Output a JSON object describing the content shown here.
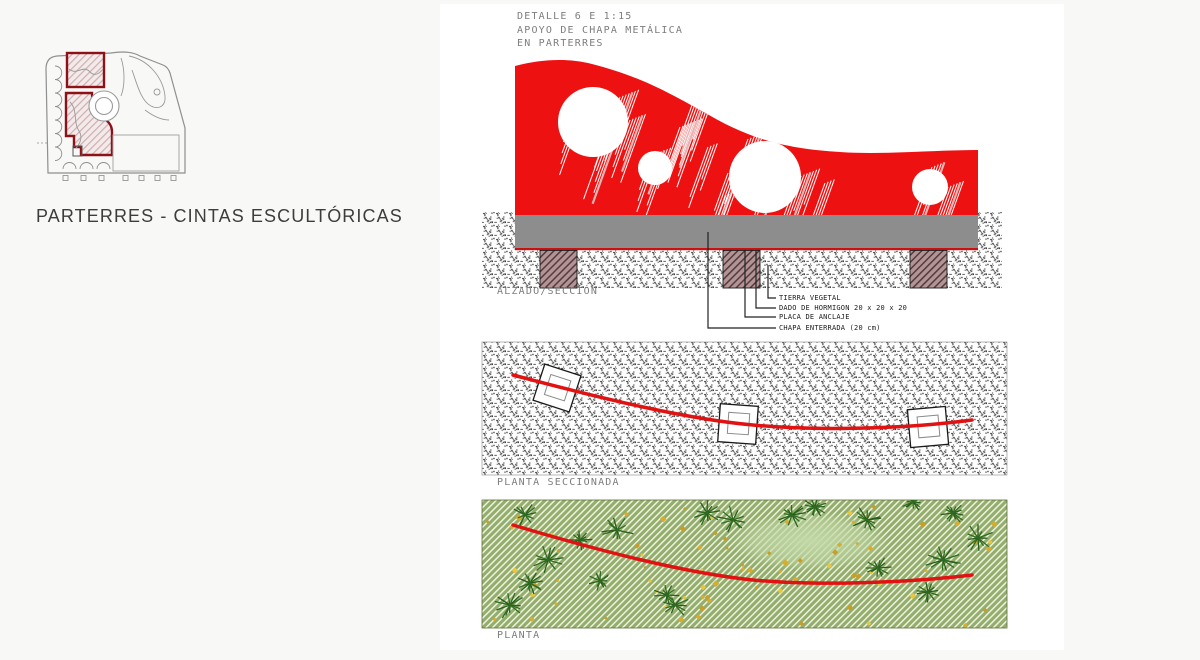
{
  "left_panel": {
    "title": "PARTERRES - CINTAS ESCULTÓRICAS"
  },
  "detail": {
    "title_lines": [
      "DETALLE 6 E 1:15",
      "APOYO DE CHAPA METÁLICA",
      "EN PARTERRES"
    ],
    "views": {
      "elevation": {
        "label": "ALZADO/SECCIÓN"
      },
      "sectioned_plan": {
        "label": "PLANTA SECCIONADA"
      },
      "plan": {
        "label": "PLANTA"
      }
    },
    "annotations": [
      "TIERRA VEGETAL",
      "DADO DE HORMIGON 20 x 20 x 20",
      "PLACA DE ANCLAJE",
      "CHAPA ENTERRADA (20 cm)"
    ]
  },
  "colors": {
    "ribbon_red": "#ee1111",
    "curve_red": "#e01212",
    "underline_red": "#c91111",
    "highlight_maroon": "#8e1118",
    "plate_gray": "#8d8d8d",
    "ground_speckle": "#4a4a4a",
    "concrete_mauve": "#b29496",
    "grass_green": "#92ad6c",
    "plant_green": "#2e6b20",
    "flower_yellow": "#e8c63e",
    "cad_text_gray": "#7d7d7d",
    "annotation_black": "#1c1c1c"
  }
}
